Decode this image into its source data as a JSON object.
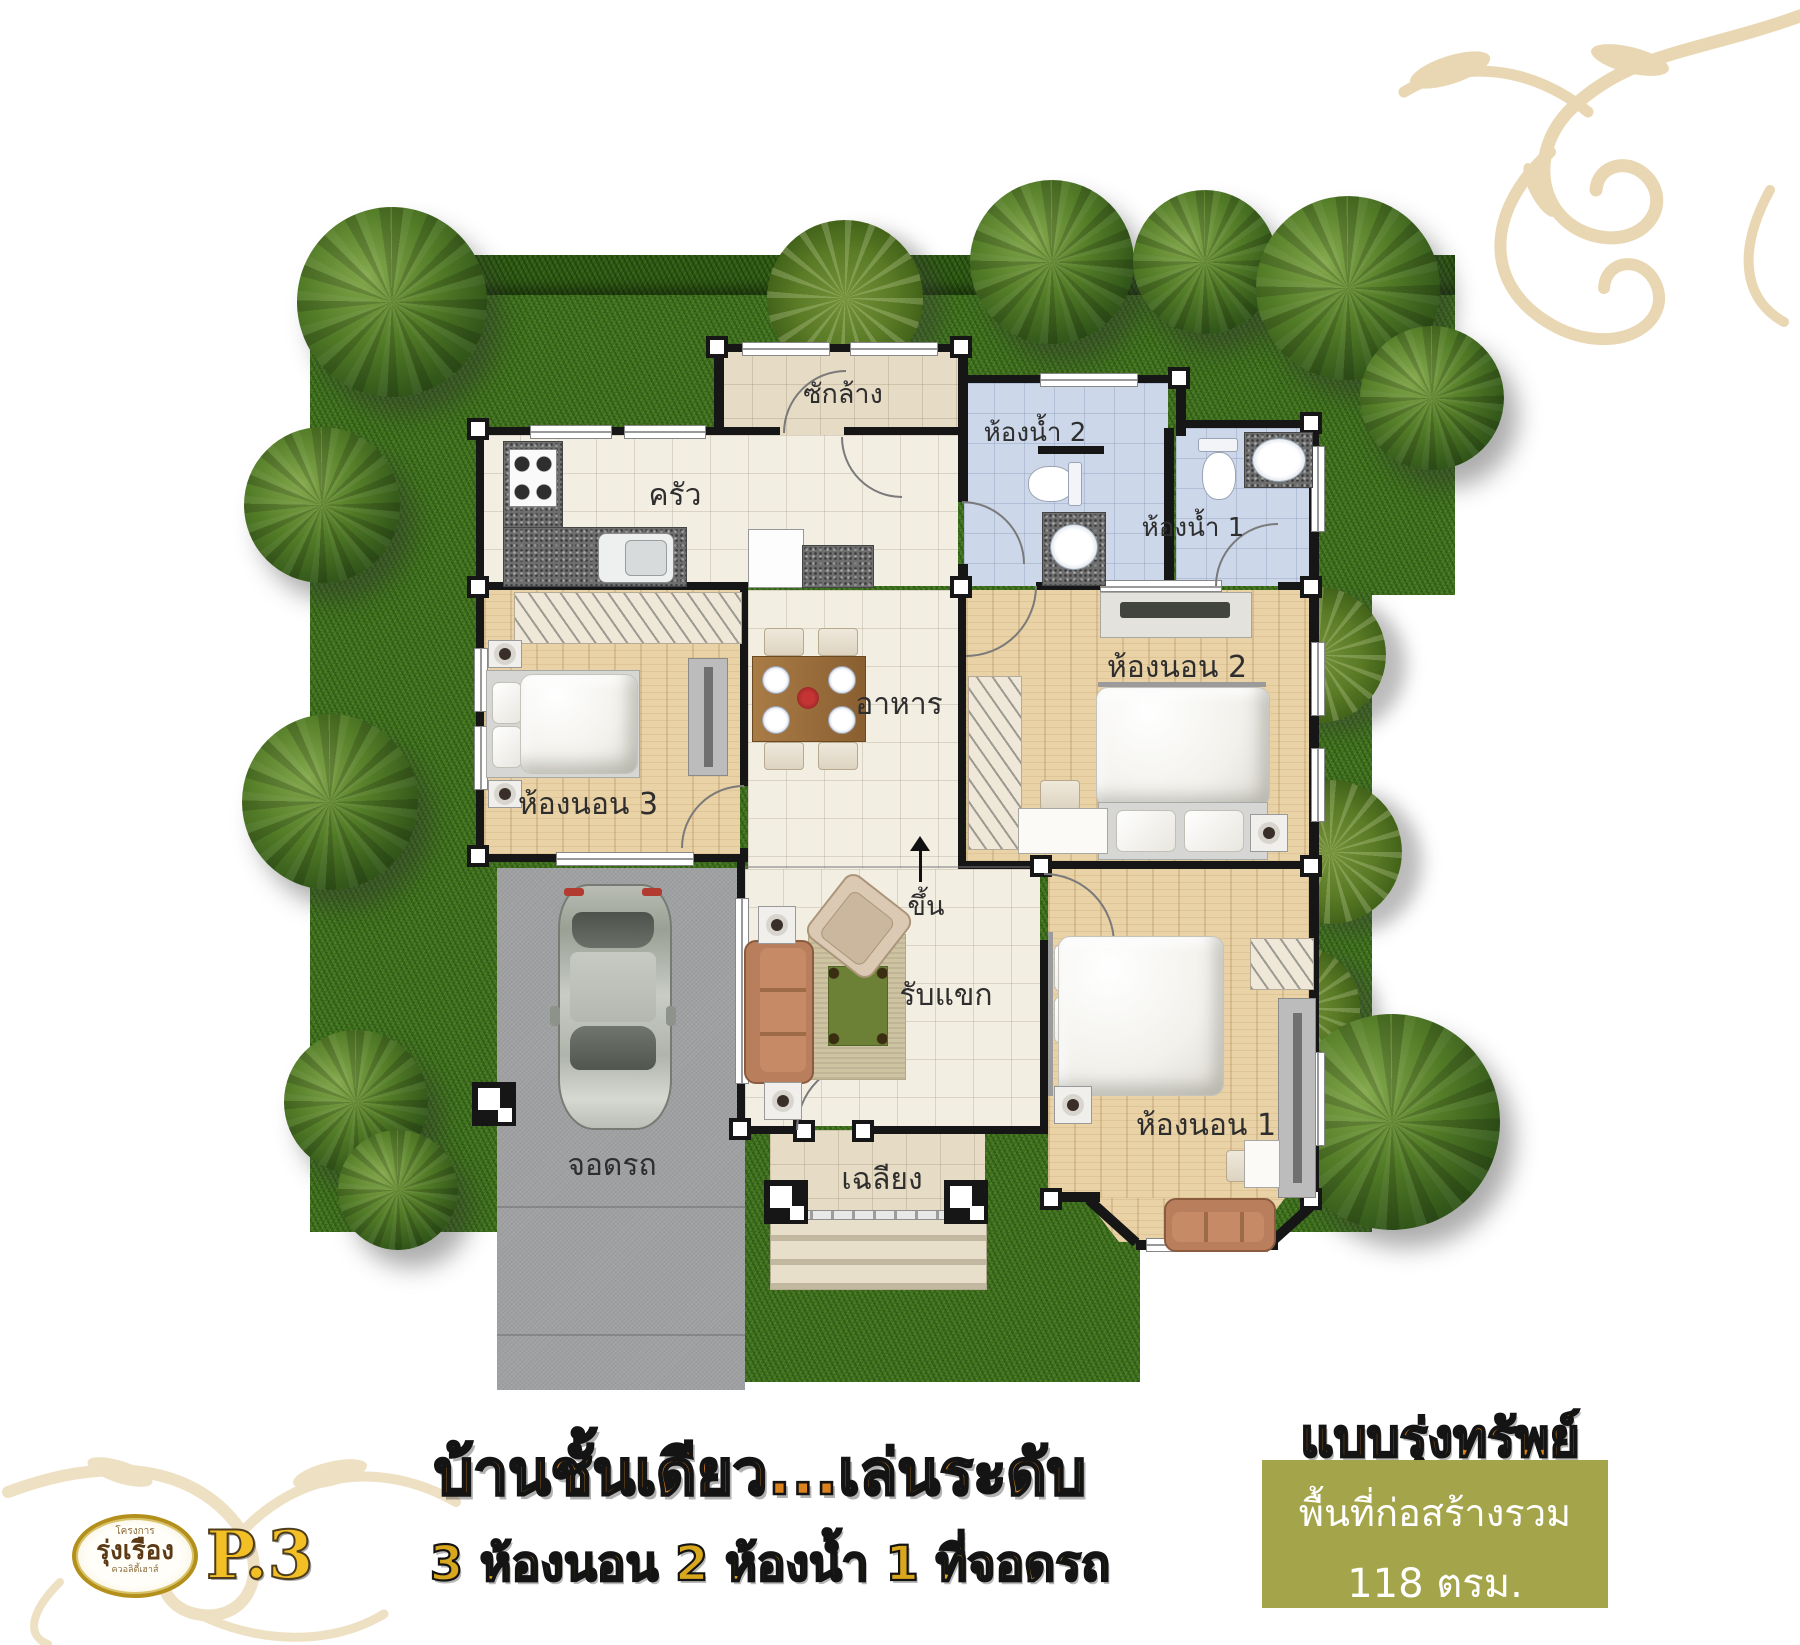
{
  "plan": {
    "rooms": {
      "laundry": "ซักล้าง",
      "bathroom2": "ห้องน้ำ 2",
      "bathroom1": "ห้องน้ำ 1",
      "kitchen": "ครัว",
      "dining": "อาหาร",
      "bedroom3": "ห้องนอน 3",
      "bedroom2": "ห้องนอน 2",
      "living": "รับแขก",
      "bedroom1": "ห้องนอน 1",
      "carpark": "จอดรถ",
      "porch": "เฉลียง",
      "stairs_up": "ขึ้น"
    }
  },
  "footer": {
    "headline": "บ้านชั้นเดียว...เล่นระดับ",
    "features": "3 ห้องนอน 2 ห้องน้ำ 1 ที่จอดรถ",
    "model_name": "แบบรุ่งทรัพย์",
    "area_label": "พื้นที่ก่อสร้างรวม",
    "area_value": "118 ตรม.",
    "page_number": "P.3"
  },
  "logo": {
    "project_word": "โครงการ",
    "brand_name": "รุ่งเรือง",
    "tagline": "ควอลิตี้เฮาส์"
  },
  "colors": {
    "accent_orange": "#d9821e",
    "accent_gold": "#d9a71e",
    "olive_box": "#a4a44a",
    "grass_green": "#41751f",
    "wall_black": "#161616",
    "wood_floor": "#e9d2a6",
    "tile_cream": "#f3eee2",
    "bath_blue": "#ccd7e9",
    "laundry_tan": "#e6dbc4",
    "driveway_gray": "#9fa1a3"
  }
}
